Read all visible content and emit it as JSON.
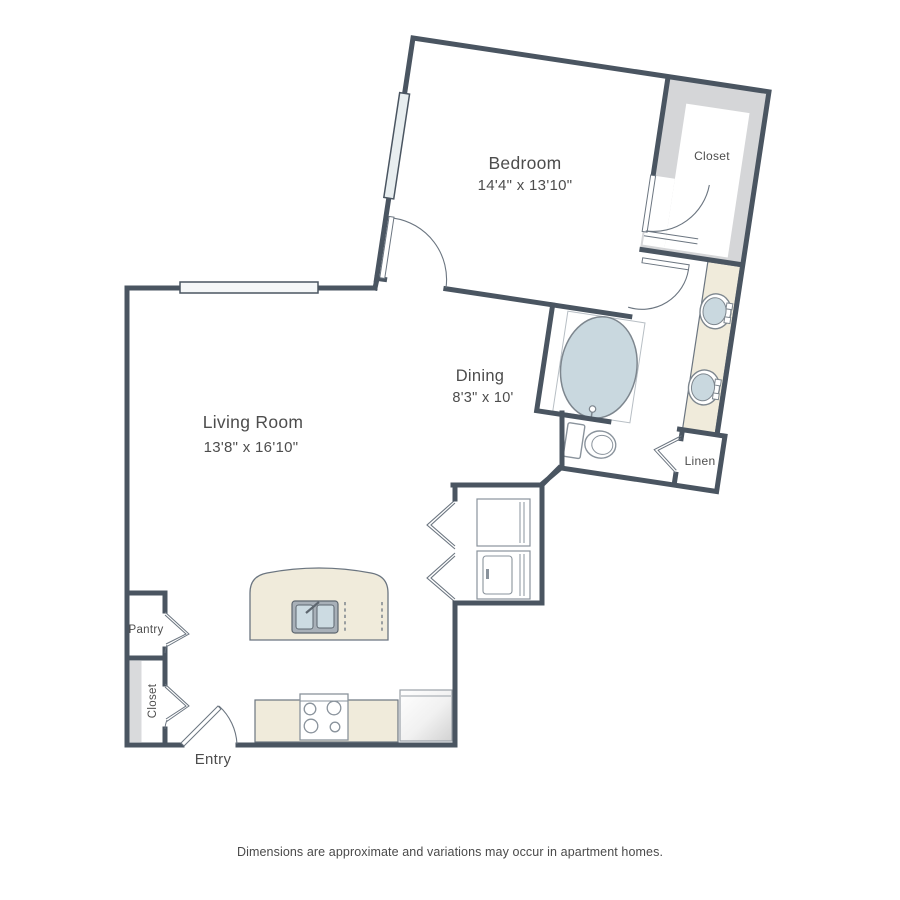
{
  "floorplan": {
    "rooms": {
      "bedroom": {
        "name": "Bedroom",
        "dims": "14'4\" x 13'10\""
      },
      "living_room": {
        "name": "Living Room",
        "dims": "13'8\" x 16'10\""
      },
      "dining": {
        "name": "Dining",
        "dims": "8'3\" x 10'"
      },
      "bedroom_closet": {
        "name": "Closet"
      },
      "linen_closet": {
        "name": "Linen"
      },
      "pantry": {
        "name": "Pantry"
      },
      "hall_closet": {
        "name": "Closet"
      },
      "entry": {
        "name": "Entry"
      }
    },
    "disclaimer": "Dimensions are approximate and variations may occur in apartment homes.",
    "colors": {
      "wall": "#4a5561",
      "counter_fill": "#f0ebdb",
      "closet_fill": "#d5d6d8",
      "fixture_fill": "#c9d8df",
      "fixture_outline": "#7d868e",
      "label_text": "#4d4d4d"
    }
  }
}
